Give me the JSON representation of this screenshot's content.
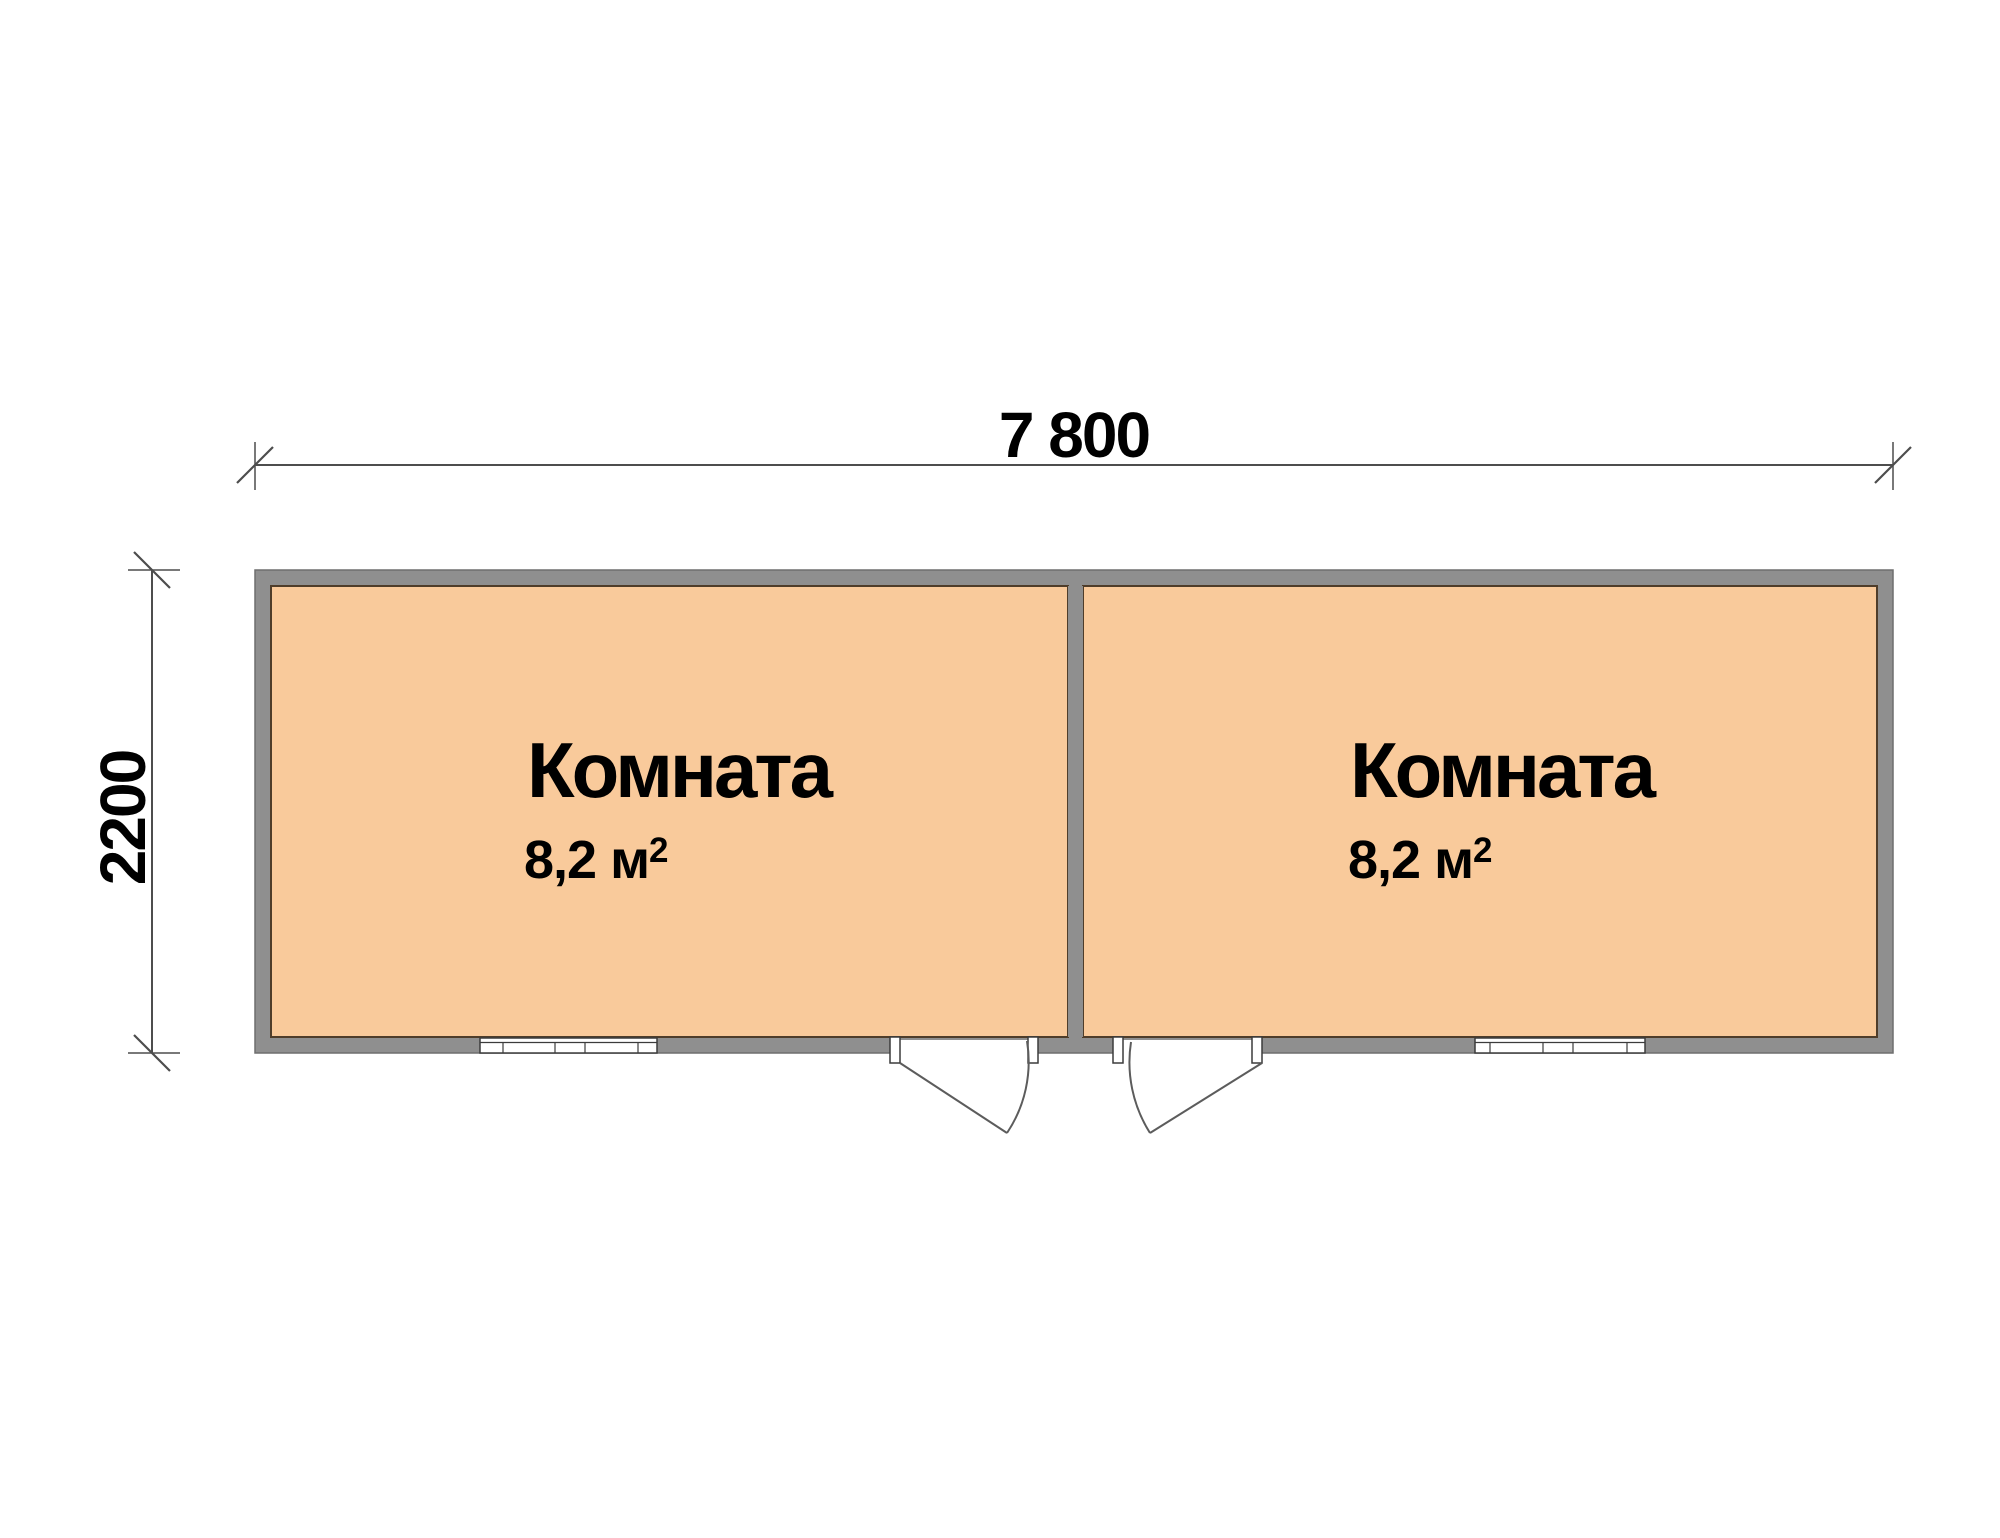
{
  "plan": {
    "dimension_width": {
      "label": "7 800"
    },
    "dimension_height": {
      "label": "2200"
    },
    "rooms": [
      {
        "name": "Комната",
        "area_value": "8,2 м",
        "area_sup": "2"
      },
      {
        "name": "Комната",
        "area_value": "8,2 м",
        "area_sup": "2"
      }
    ]
  },
  "colors": {
    "background": "#FFFFFF",
    "room_fill": "#F9CA9B",
    "wall_fill": "#8F8F8F",
    "wall_edge": "#6E6E6E",
    "room_outline": "#4F3D2A",
    "dim_line": "#4D4D4D",
    "detail_line": "#3C3C3C",
    "text": "#000000"
  }
}
